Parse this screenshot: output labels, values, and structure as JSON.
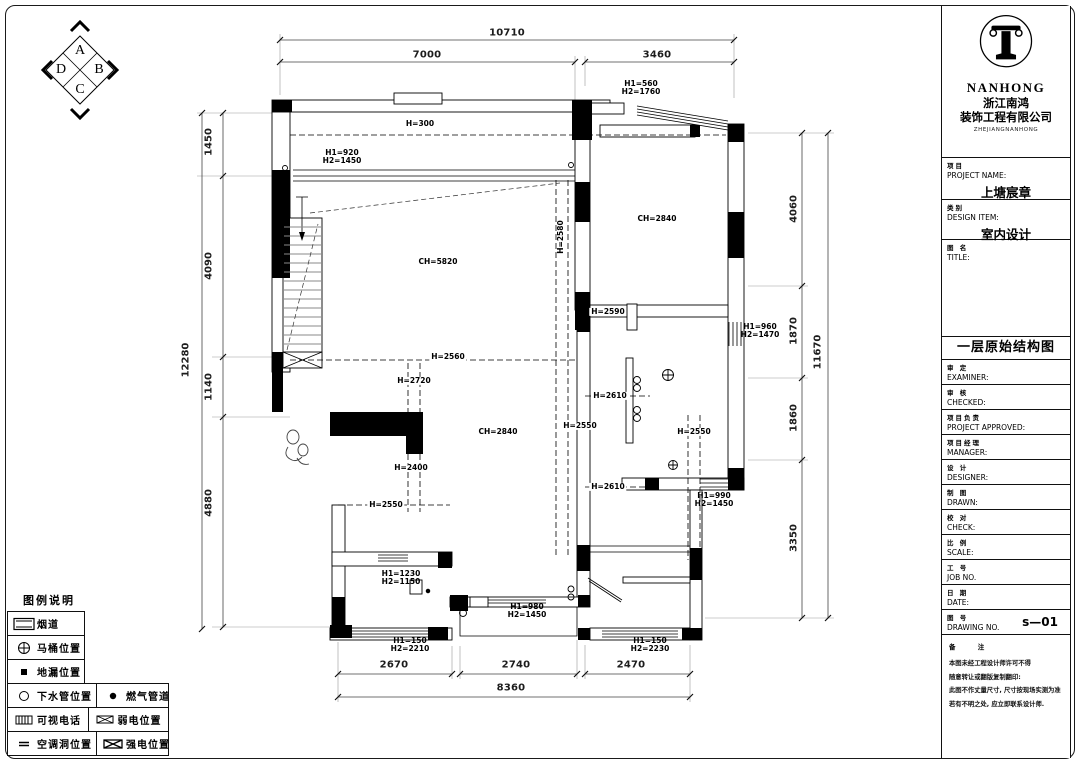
{
  "colors": {
    "line": "#000000",
    "paper": "#ffffff"
  },
  "compass": {
    "a": "A",
    "b": "B",
    "c": "C",
    "d": "D"
  },
  "plan": {
    "labels": [
      {
        "t": "10710",
        "x": 507,
        "y": 33,
        "cls": "dim"
      },
      {
        "t": "7000",
        "x": 427,
        "y": 55,
        "cls": "dim"
      },
      {
        "t": "3460",
        "x": 657,
        "y": 55,
        "cls": "dim"
      },
      {
        "t": "1450",
        "x": 209,
        "y": 142,
        "cls": "dimv"
      },
      {
        "t": "4090",
        "x": 209,
        "y": 266,
        "cls": "dimv"
      },
      {
        "t": "1140",
        "x": 209,
        "y": 387,
        "cls": "dimv"
      },
      {
        "t": "4880",
        "x": 209,
        "y": 503,
        "cls": "dimv"
      },
      {
        "t": "12280",
        "x": 186,
        "y": 360,
        "cls": "dimv"
      },
      {
        "t": "4060",
        "x": 794,
        "y": 209,
        "cls": "dimv"
      },
      {
        "t": "1870",
        "x": 794,
        "y": 331,
        "cls": "dimv"
      },
      {
        "t": "1860",
        "x": 794,
        "y": 418,
        "cls": "dimv"
      },
      {
        "t": "3350",
        "x": 794,
        "y": 538,
        "cls": "dimv"
      },
      {
        "t": "11670",
        "x": 818,
        "y": 352,
        "cls": "dimv"
      },
      {
        "t": "2670",
        "x": 394,
        "y": 665,
        "cls": "dim"
      },
      {
        "t": "2740",
        "x": 516,
        "y": 665,
        "cls": "dim"
      },
      {
        "t": "2470",
        "x": 631,
        "y": 665,
        "cls": "dim"
      },
      {
        "t": "8360",
        "x": 511,
        "y": 688,
        "cls": "dim"
      },
      {
        "t": "H=300",
        "x": 420,
        "y": 124,
        "cls": ""
      },
      {
        "t": "H1=920\nH2=1450",
        "x": 342,
        "y": 157,
        "cls": ""
      },
      {
        "t": "H1=560\nH2=1760",
        "x": 641,
        "y": 88,
        "cls": ""
      },
      {
        "t": "CH=5820",
        "x": 438,
        "y": 262,
        "cls": ""
      },
      {
        "t": "CH=2840",
        "x": 657,
        "y": 219,
        "cls": ""
      },
      {
        "t": "H=2580",
        "x": 561,
        "y": 237,
        "cls": "hv"
      },
      {
        "t": "H=2590",
        "x": 608,
        "y": 312,
        "cls": "hb"
      },
      {
        "t": "H1=960\nH2=1470",
        "x": 760,
        "y": 331,
        "cls": ""
      },
      {
        "t": "H=2560",
        "x": 448,
        "y": 357,
        "cls": "hb"
      },
      {
        "t": "H=2720",
        "x": 414,
        "y": 381,
        "cls": "hb"
      },
      {
        "t": "H=2610",
        "x": 610,
        "y": 396,
        "cls": "hb"
      },
      {
        "t": "H=2550",
        "x": 580,
        "y": 426,
        "cls": "hb"
      },
      {
        "t": "H=2550",
        "x": 694,
        "y": 432,
        "cls": "hb"
      },
      {
        "t": "CH=2840",
        "x": 498,
        "y": 432,
        "cls": ""
      },
      {
        "t": "H=2400",
        "x": 411,
        "y": 468,
        "cls": "hb"
      },
      {
        "t": "H=2610",
        "x": 608,
        "y": 487,
        "cls": "hb"
      },
      {
        "t": "H1=990\nH2=1450",
        "x": 714,
        "y": 500,
        "cls": ""
      },
      {
        "t": "H=2550",
        "x": 386,
        "y": 505,
        "cls": "hb"
      },
      {
        "t": "H1=1230\nH2=1150",
        "x": 401,
        "y": 578,
        "cls": ""
      },
      {
        "t": "H1=980\nH2=1450",
        "x": 527,
        "y": 611,
        "cls": ""
      },
      {
        "t": "H1=150\nH2=2210",
        "x": 410,
        "y": 645,
        "cls": ""
      },
      {
        "t": "H1=150\nH2=2230",
        "x": 650,
        "y": 645,
        "cls": ""
      },
      {
        "t": "A",
        "x": 80,
        "y": 51,
        "cls": "cmp"
      },
      {
        "t": "B",
        "x": 99,
        "y": 70,
        "cls": "cmp"
      },
      {
        "t": "C",
        "x": 80,
        "y": 90,
        "cls": "cmp"
      },
      {
        "t": "D",
        "x": 61,
        "y": 70,
        "cls": "cmp"
      }
    ]
  },
  "legend": {
    "title": "图例说明",
    "rows": [
      {
        "cells": [
          {
            "icon": "flue-icon",
            "label": "烟道"
          }
        ]
      },
      {
        "cells": [
          {
            "icon": "toilet-icon",
            "label": "马桶位置"
          }
        ]
      },
      {
        "cells": [
          {
            "icon": "floor-drain-icon",
            "label": "地漏位置"
          }
        ]
      },
      {
        "cells": [
          {
            "icon": "drain-pipe-icon",
            "label": "下水管位置"
          },
          {
            "icon": "gas-pipe-icon",
            "label": "燃气管道"
          }
        ]
      },
      {
        "cells": [
          {
            "icon": "video-phone-icon",
            "label": "可视电话"
          },
          {
            "icon": "weak-current-icon",
            "label": "弱电位置"
          }
        ]
      },
      {
        "cells": [
          {
            "icon": "ac-hole-icon",
            "label": "空调洞位置"
          },
          {
            "icon": "strong-current-icon",
            "label": "强电位置"
          }
        ]
      }
    ]
  },
  "titleblock": {
    "brand": {
      "name": "NANHONG",
      "cn1": "浙江南鸿",
      "cn2": "装饰工程有限公司",
      "sub": "ZHEJIANGNANHONG"
    },
    "project": {
      "cn": "项目",
      "en": "PROJECT NAME:",
      "value": "上塘宸章"
    },
    "design": {
      "cn": "类别",
      "en": "DESIGN ITEM:",
      "value": "室内设计"
    },
    "title_field": {
      "cn": "图 名",
      "en": "TITLE:"
    },
    "drawing_title": "一层原始结构图",
    "rows": [
      {
        "cn": "审 定",
        "en": "EXAMINER:"
      },
      {
        "cn": "审 核",
        "en": "CHECKED:"
      },
      {
        "cn": "项目负责",
        "en": "PROJECT APPROVED:"
      },
      {
        "cn": "项目经理",
        "en": "MANAGER:"
      },
      {
        "cn": "设 计",
        "en": "DESIGNER:"
      },
      {
        "cn": "制 图",
        "en": "DRAWN:"
      },
      {
        "cn": "校 对",
        "en": "CHECK:"
      },
      {
        "cn": "比 例",
        "en": "SCALE:"
      },
      {
        "cn": "工 号",
        "en": "JOB NO."
      },
      {
        "cn": "日 期",
        "en": "DATE:"
      },
      {
        "cn": "图 号",
        "en": "DRAWING NO.",
        "value": "s—01"
      }
    ],
    "notes": {
      "cn": "备 注",
      "lines": [
        "本图未经工程设计师许可不得",
        "随意转让或翻版复制翻印:",
        "此图不作丈量尺寸, 尺寸按现场实测为准",
        "若有不明之处, 应立即联系设计师."
      ]
    }
  }
}
